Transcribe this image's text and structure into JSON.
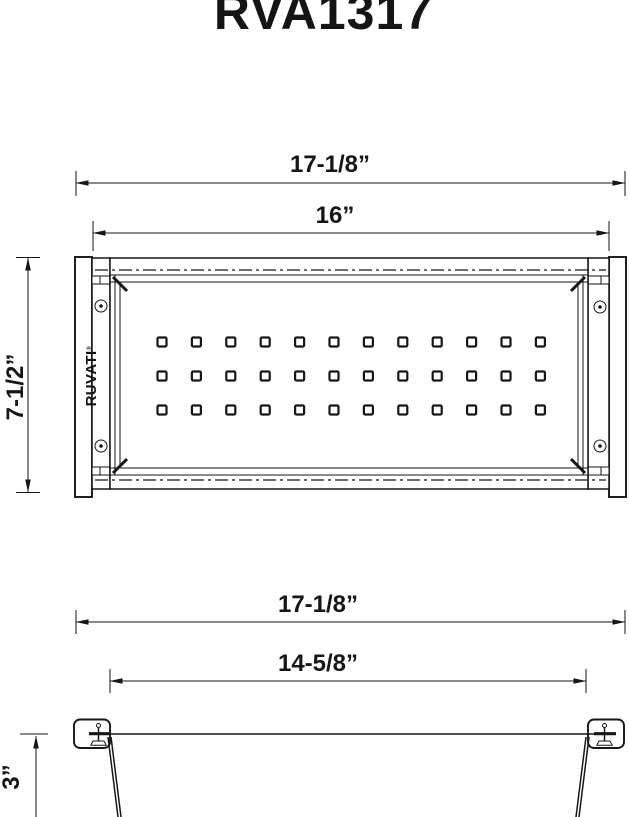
{
  "title": "RVA1317",
  "brand": {
    "logo_text": "RUVATI",
    "registered_mark": "®"
  },
  "top_view": {
    "dim_overall_width": "17-1/8”",
    "dim_inner_width": "16”",
    "dim_front_to_back": "7-1/2”",
    "perforations": {
      "rows": 3,
      "columns": 12
    }
  },
  "front_view": {
    "dim_overall_width": "17-1/8”",
    "dim_base_width": "14-5/8”",
    "dim_depth": "3”"
  },
  "colors": {
    "line": "#161616",
    "background": "#ffffff"
  }
}
